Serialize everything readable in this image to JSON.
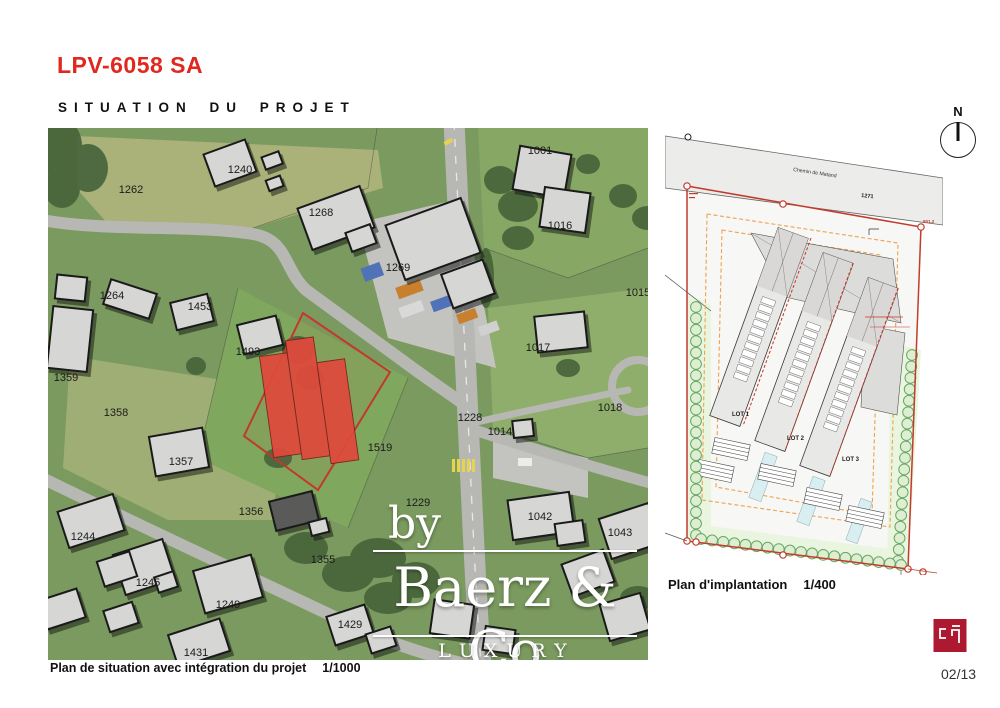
{
  "header": {
    "title": "LPV-6058 SA",
    "subtitle": "SITUATION DU PROJET"
  },
  "colors": {
    "accent_red": "#e0281e",
    "highlight_red": "#e0493c",
    "logo_red": "#ae1932",
    "hedge_green": "#66a861",
    "setback_orange": "#eda24f"
  },
  "map": {
    "caption": "Plan de situation avec intégration du projet",
    "caption_scale": "1/1000",
    "watermark": {
      "by": "by",
      "name": "Baerz & Co",
      "tagline": "LUXURY HOMES"
    },
    "parcel_labels": [
      {
        "text": "1262",
        "x": 83,
        "y": 62
      },
      {
        "text": "1240",
        "x": 192,
        "y": 42
      },
      {
        "text": "1268",
        "x": 273,
        "y": 85
      },
      {
        "text": "1269",
        "x": 350,
        "y": 140
      },
      {
        "text": "1001",
        "x": 492,
        "y": 23
      },
      {
        "text": "1016",
        "x": 512,
        "y": 98
      },
      {
        "text": "1015",
        "x": 590,
        "y": 165
      },
      {
        "text": "1264",
        "x": 64,
        "y": 168
      },
      {
        "text": "1453",
        "x": 152,
        "y": 179
      },
      {
        "text": "1493",
        "x": 200,
        "y": 224
      },
      {
        "text": "1359",
        "x": 18,
        "y": 250
      },
      {
        "text": "1358",
        "x": 68,
        "y": 285
      },
      {
        "text": "1357",
        "x": 133,
        "y": 334
      },
      {
        "text": "1356",
        "x": 203,
        "y": 384
      },
      {
        "text": "1355",
        "x": 275,
        "y": 432
      },
      {
        "text": "1519",
        "x": 332,
        "y": 320
      },
      {
        "text": "1228",
        "x": 422,
        "y": 290
      },
      {
        "text": "1014",
        "x": 452,
        "y": 304
      },
      {
        "text": "1017",
        "x": 490,
        "y": 220
      },
      {
        "text": "1018",
        "x": 562,
        "y": 280
      },
      {
        "text": "1229",
        "x": 370,
        "y": 375
      },
      {
        "text": "1042",
        "x": 492,
        "y": 389
      },
      {
        "text": "1043",
        "x": 572,
        "y": 405
      },
      {
        "text": "1244",
        "x": 35,
        "y": 409
      },
      {
        "text": "1245",
        "x": 100,
        "y": 455
      },
      {
        "text": "1249",
        "x": 180,
        "y": 477
      },
      {
        "text": "1429",
        "x": 302,
        "y": 497
      },
      {
        "text": "1431",
        "x": 148,
        "y": 525
      }
    ]
  },
  "plan": {
    "caption": "Plan d'implantation",
    "caption_scale": "1/400",
    "road_label": "Chemin de Matand",
    "road_parcel": "1271",
    "corner_note": "801.2",
    "north_label": "N",
    "lots": [
      "LOT 1",
      "LOT 2",
      "LOT 3"
    ]
  },
  "footer": {
    "page_number": "02/13"
  }
}
